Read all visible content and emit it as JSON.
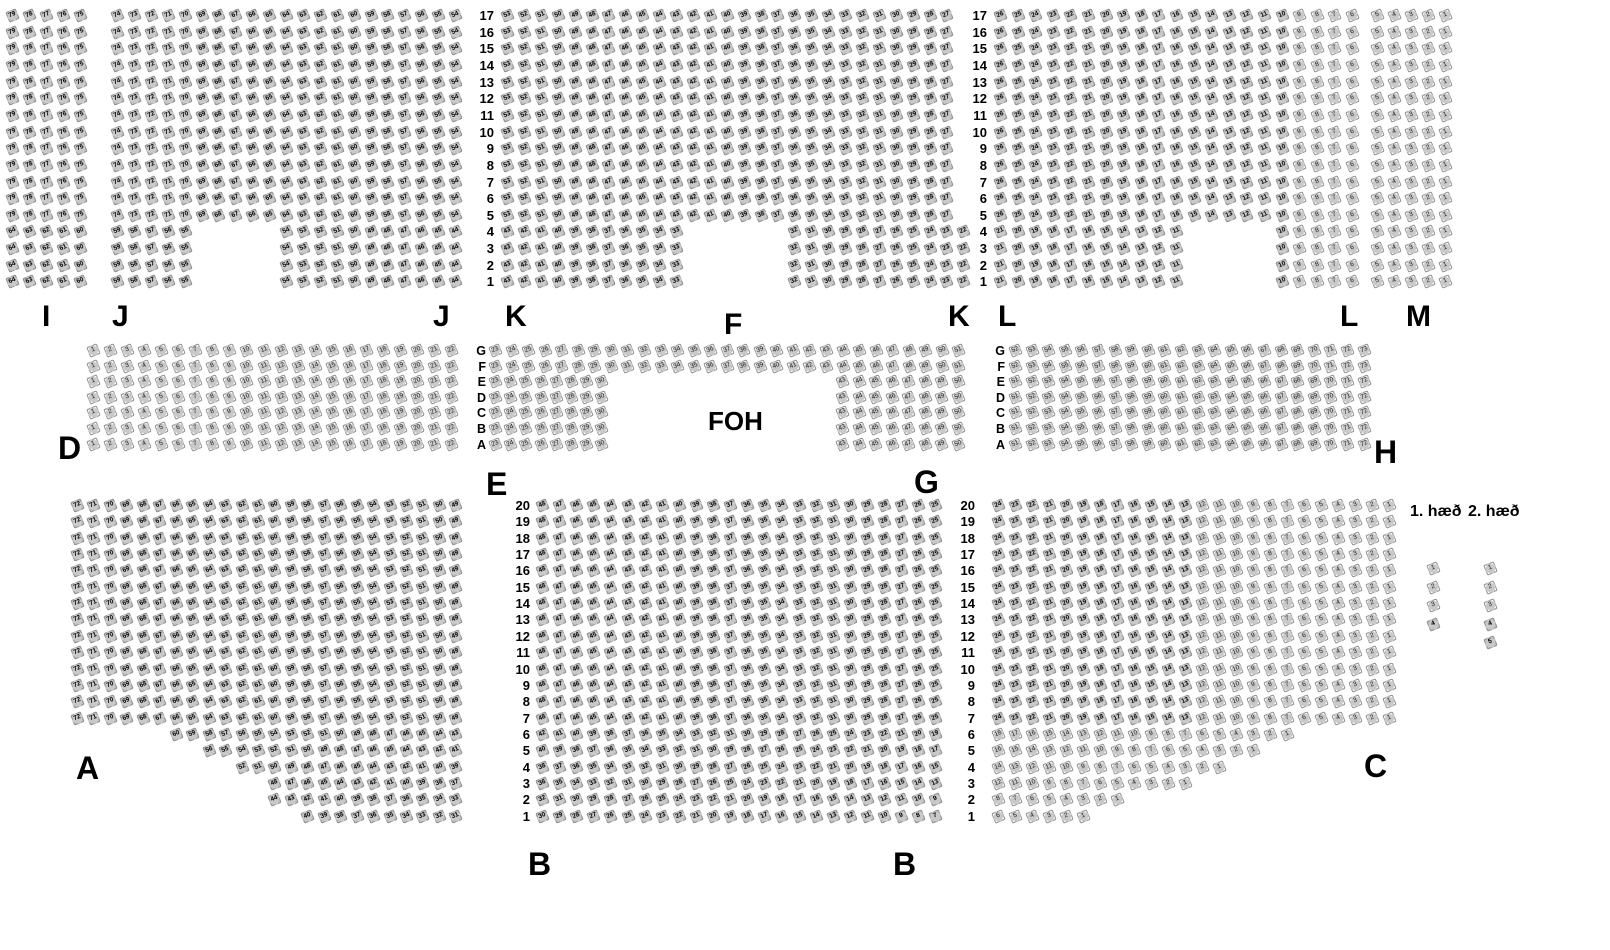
{
  "page": {
    "width": 1610,
    "height": 950,
    "background": "#ffffff"
  },
  "foh_label": "FOH",
  "legend": {
    "floor1_label": "1. hæð",
    "floor2_label": "2. hæð",
    "columns": [
      {
        "name": "floor1-seat-column",
        "x": 1428,
        "y": 563,
        "pitch": 18.5,
        "seats": [
          {
            "num": 1,
            "state": "light"
          },
          {
            "num": 2,
            "state": "light"
          },
          {
            "num": 3,
            "state": "light"
          },
          {
            "num": 4,
            "state": "dark"
          }
        ]
      },
      {
        "name": "floor2-seat-column",
        "x": 1485,
        "y": 563,
        "pitch": 18.5,
        "seats": [
          {
            "num": 1,
            "state": "light"
          },
          {
            "num": 2,
            "state": "light"
          },
          {
            "num": 3,
            "state": "light"
          },
          {
            "num": 4,
            "state": "dark"
          },
          {
            "num": 5,
            "state": "dark"
          }
        ]
      }
    ]
  },
  "section_labels": [
    {
      "text": "I",
      "x": 42,
      "y": 300,
      "size": 30
    },
    {
      "text": "J",
      "x": 112,
      "y": 300,
      "size": 30
    },
    {
      "text": "J",
      "x": 433,
      "y": 300,
      "size": 30
    },
    {
      "text": "K",
      "x": 505,
      "y": 300,
      "size": 30
    },
    {
      "text": "K",
      "x": 948,
      "y": 300,
      "size": 30
    },
    {
      "text": "L",
      "x": 998,
      "y": 300,
      "size": 30
    },
    {
      "text": "L",
      "x": 1340,
      "y": 300,
      "size": 30
    },
    {
      "text": "M",
      "x": 1406,
      "y": 300,
      "size": 30
    },
    {
      "text": "F",
      "x": 724,
      "y": 308,
      "size": 30
    },
    {
      "text": "D",
      "x": 58,
      "y": 430,
      "size": 32
    },
    {
      "text": "E",
      "x": 486,
      "y": 466,
      "size": 32
    },
    {
      "text": "G",
      "x": 914,
      "y": 464,
      "size": 32
    },
    {
      "text": "H",
      "x": 1374,
      "y": 434,
      "size": 32
    },
    {
      "text": "A",
      "x": 76,
      "y": 750,
      "size": 32
    },
    {
      "text": "B",
      "x": 528,
      "y": 846,
      "size": 32
    },
    {
      "text": "B",
      "x": 893,
      "y": 846,
      "size": 32
    },
    {
      "text": "C",
      "x": 1364,
      "y": 748,
      "size": 32
    }
  ],
  "foh_position": {
    "x": 708,
    "y": 406
  },
  "row_number_columns": [
    {
      "name": "balcony-rows-left",
      "x_right": 494,
      "y": 10,
      "pitch": 16.65,
      "values": [
        17,
        16,
        15,
        14,
        13,
        12,
        11,
        10,
        9,
        8,
        7,
        6,
        5,
        4,
        3,
        2,
        1
      ]
    },
    {
      "name": "balcony-rows-right",
      "x_right": 987,
      "y": 10,
      "pitch": 16.65,
      "values": [
        17,
        16,
        15,
        14,
        13,
        12,
        11,
        10,
        9,
        8,
        7,
        6,
        5,
        4,
        3,
        2,
        1
      ]
    },
    {
      "name": "stalls-rows-left",
      "x_right": 530,
      "y": 500,
      "pitch": 16.35,
      "values": [
        20,
        19,
        18,
        17,
        16,
        15,
        14,
        13,
        12,
        11,
        10,
        9,
        8,
        7,
        6,
        5,
        4,
        3,
        2,
        1
      ]
    },
    {
      "name": "stalls-rows-right",
      "x_right": 975,
      "y": 500,
      "pitch": 16.35,
      "values": [
        20,
        19,
        18,
        17,
        16,
        15,
        14,
        13,
        12,
        11,
        10,
        9,
        8,
        7,
        6,
        5,
        4,
        3,
        2,
        1
      ]
    }
  ],
  "row_letter_columns": [
    {
      "name": "middle-letters-left",
      "x_right": 486,
      "y": 345,
      "pitch": 15.6,
      "letters": [
        "G",
        "F",
        "E",
        "D",
        "C",
        "B",
        "A"
      ]
    },
    {
      "name": "middle-letters-right",
      "x_right": 1005,
      "y": 345,
      "pitch": 15.6,
      "letters": [
        "G",
        "F",
        "E",
        "D",
        "C",
        "B",
        "A"
      ]
    }
  ],
  "bands": {
    "top": {
      "y": 10,
      "row_pitch": 16.65,
      "row_from": 17,
      "low_rows_max": 4,
      "sections": [
        {
          "name": "I",
          "x": 7,
          "col_pitch": 17.0,
          "state": "dark",
          "full": [
            {
              "col": 0,
              "n": 5,
              "start": 79
            }
          ],
          "low": [
            {
              "col": 0,
              "n": 5,
              "start": 64
            }
          ]
        },
        {
          "name": "J",
          "x": 112,
          "col_pitch": 16.9,
          "state": "dark",
          "full": [
            {
              "col": 0,
              "n": 21,
              "start": 74
            }
          ],
          "low": [
            {
              "col": 0,
              "n": 5,
              "start": 59
            },
            {
              "col": 10,
              "n": 11,
              "start": 54
            }
          ]
        },
        {
          "name": "K",
          "x": 502,
          "col_pitch": 16.9,
          "state": "dark",
          "full": [
            {
              "col": 0,
              "n": 27,
              "start": 53
            }
          ],
          "low": [
            {
              "col": 0,
              "n": 11,
              "start": 43
            },
            {
              "col": 17,
              "n": 11,
              "start": 32
            }
          ]
        },
        {
          "name": "L",
          "x": 995,
          "col_pitch": 17.6,
          "state": "dark",
          "light_if_num_lte": 9,
          "full": [
            {
              "col": 0,
              "n": 21,
              "start": 26
            }
          ],
          "low": [
            {
              "col": 0,
              "n": 11,
              "start": 21
            },
            {
              "col": 16,
              "n": 5,
              "start": 10
            }
          ]
        },
        {
          "name": "M",
          "x": 1372,
          "col_pitch": 17.0,
          "state": "light",
          "full": [
            {
              "col": 0,
              "n": 5,
              "start": 5
            }
          ],
          "low": [
            {
              "col": 0,
              "n": 5,
              "start": 5
            }
          ]
        }
      ]
    },
    "middle": {
      "y": 345,
      "row_pitch": 15.6,
      "row_letters": [
        "G",
        "F",
        "E",
        "D",
        "C",
        "B",
        "A"
      ],
      "blocks": [
        {
          "name": "D",
          "x": 88,
          "col_pitch": 17.05,
          "rows": "all",
          "n": 22,
          "start": 1,
          "state": "light"
        },
        {
          "name": "F",
          "x": 490,
          "col_pitch": 16.55,
          "rows": [
            "G",
            "F"
          ],
          "n": 29,
          "start": 23,
          "state": "light"
        },
        {
          "name": "E",
          "x": 490,
          "col_pitch": 15.2,
          "rows": [
            "E",
            "D",
            "C",
            "B",
            "A"
          ],
          "n": 8,
          "start": 23,
          "state": "light"
        },
        {
          "name": "G",
          "x": 837,
          "col_pitch": 16.55,
          "rows": [
            "E",
            "D",
            "C",
            "B",
            "A"
          ],
          "n": 8,
          "start": 43,
          "state": "light"
        },
        {
          "name": "H-gf",
          "x": 1010,
          "col_pitch": 16.6,
          "rows": [
            "G",
            "F"
          ],
          "n": 22,
          "start": 52,
          "state": "light"
        },
        {
          "name": "H",
          "x": 1010,
          "col_pitch": 16.6,
          "rows": [
            "E",
            "D",
            "C",
            "B",
            "A"
          ],
          "n": 22,
          "start": 51,
          "state": "light"
        }
      ]
    },
    "bottom": {
      "y": 500,
      "row_pitch": 16.35,
      "row_from": 20,
      "low_rows_max": 6,
      "sections": [
        {
          "name": "A",
          "x": 72,
          "col_pitch": 16.45,
          "state": "dark",
          "full": [
            {
              "col": 0,
              "n": 24,
              "start": 72
            }
          ],
          "low": {
            "6": [
              {
                "col": 6,
                "n": 18,
                "start": 60
              }
            ],
            "5": [
              {
                "col": 8,
                "n": 16,
                "start": 56
              }
            ],
            "4": [
              {
                "col": 10,
                "n": 14,
                "start": 52
              }
            ],
            "3": [
              {
                "col": 12,
                "n": 12,
                "start": 48
              }
            ],
            "2": [
              {
                "col": 12,
                "n": 12,
                "start": 44
              }
            ],
            "1": [
              {
                "col": 14,
                "n": 10,
                "start": 40
              }
            ]
          }
        },
        {
          "name": "B",
          "x": 537,
          "col_pitch": 17.1,
          "state": "dark",
          "full": [
            {
              "col": 0,
              "n": 24,
              "start": 48
            }
          ],
          "low": {
            "6": [
              {
                "col": 0,
                "n": 24,
                "start": 42
              }
            ],
            "5": [
              {
                "col": 0,
                "n": 24,
                "start": 40
              }
            ],
            "4": [
              {
                "col": 0,
                "n": 24,
                "start": 38
              }
            ],
            "3": [
              {
                "col": 0,
                "n": 24,
                "start": 36
              }
            ],
            "2": [
              {
                "col": 0,
                "n": 24,
                "start": 32
              }
            ],
            "1": [
              {
                "col": 0,
                "n": 24,
                "start": 30
              }
            ]
          }
        },
        {
          "name": "C",
          "x": 993,
          "col_pitch": 17.0,
          "state": "dark",
          "light_if_num_lte": 12,
          "light_if_row_lte": 6,
          "full": [
            {
              "col": 0,
              "n": 24,
              "start": 24
            }
          ],
          "low": {
            "6": [
              {
                "col": 0,
                "n": 18,
                "start": 18
              }
            ],
            "5": [
              {
                "col": 0,
                "n": 16,
                "start": 16
              }
            ],
            "4": [
              {
                "col": 0,
                "n": 14,
                "start": 14
              }
            ],
            "3": [
              {
                "col": 0,
                "n": 12,
                "start": 12
              }
            ],
            "2": [
              {
                "col": 0,
                "n": 8,
                "start": 8
              }
            ],
            "1": [
              {
                "col": 0,
                "n": 6,
                "start": 6
              }
            ]
          }
        }
      ]
    }
  },
  "colors": {
    "seat_face_light": "#ffffff",
    "seat_face_dark": "#c2c2c2",
    "seat_back": "#c9c9c9",
    "seat_border": "#8f8f8f",
    "label_text": "#000000"
  }
}
